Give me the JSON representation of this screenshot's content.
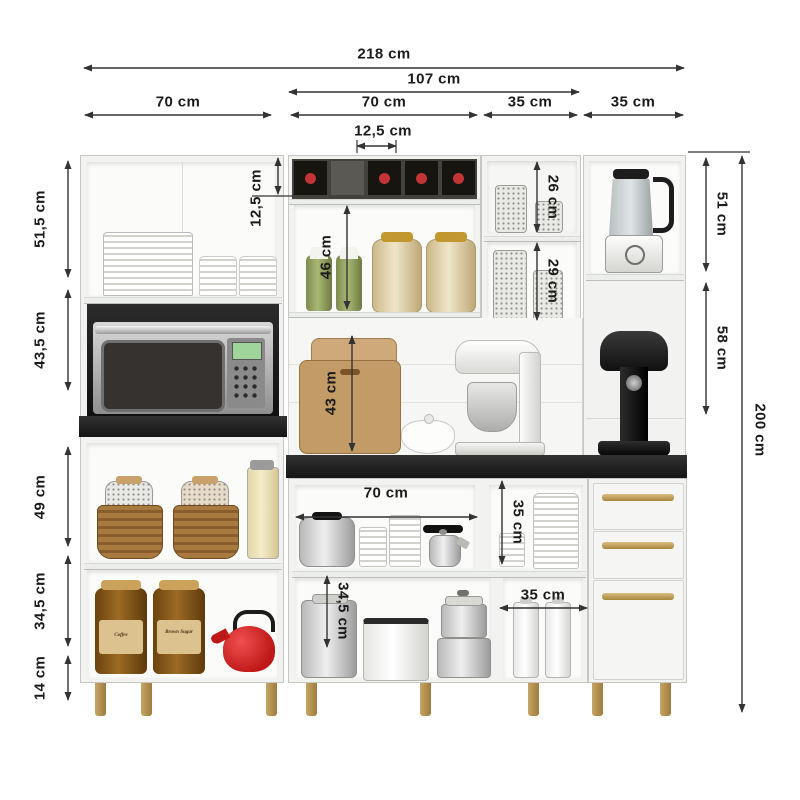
{
  "diagram": {
    "type": "furniture-dimension-diagram",
    "subject": "kitchen cabinet set with appliances",
    "unit": "cm"
  },
  "dims": {
    "w218": "218 cm",
    "w107": "107 cm",
    "w70_left": "70 cm",
    "w70_mid": "70 cm",
    "w35_a": "35 cm",
    "w35_b": "35 cm",
    "w12_5": "12,5 cm",
    "h51_5": "51,5 cm",
    "h43_5": "43,5 cm",
    "h49": "49 cm",
    "h34_5_left": "34,5 cm",
    "h14": "14 cm",
    "h12_5": "12,5 cm",
    "h46": "46 cm",
    "h43": "43 cm",
    "h26": "26 cm",
    "h29": "29 cm",
    "h51_right": "51 cm",
    "h58": "58 cm",
    "h200": "200 cm",
    "w70_base": "70 cm",
    "h35_base": "35 cm",
    "h34_5_mid": "34,5 cm",
    "w35_base": "35 cm"
  },
  "jar_labels": {
    "coffee": "Coffee",
    "sugar": "Brown Sugar"
  },
  "colors": {
    "cabinet_body": "#f2f2f0",
    "countertop": "#1d1d1d",
    "niche_dark": "#161616",
    "handle_gold": "#b5955a",
    "leg_gold": "#ad8c4c",
    "kettle_red": "#cc1f1f",
    "dimension_line": "#333333"
  }
}
